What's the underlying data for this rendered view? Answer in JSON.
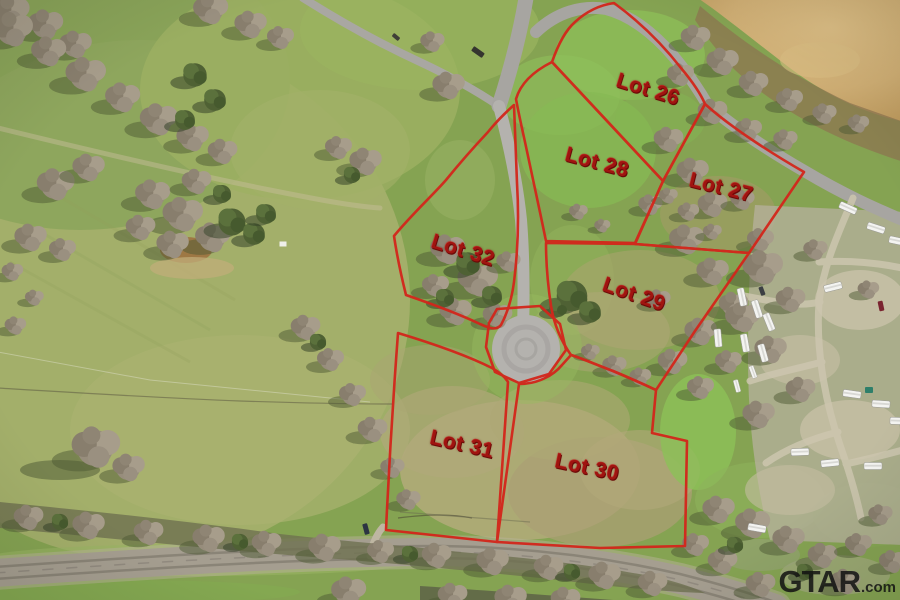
{
  "lots": [
    {
      "id": "26",
      "label": "Lot 26"
    },
    {
      "id": "27",
      "label": "Lot 27"
    },
    {
      "id": "28",
      "label": "Lot 28"
    },
    {
      "id": "29",
      "label": "Lot 29"
    },
    {
      "id": "30",
      "label": "Lot 30"
    },
    {
      "id": "31",
      "label": "Lot 31"
    },
    {
      "id": "32",
      "label": "Lot 32"
    }
  ],
  "watermark": {
    "brand": "GTAR",
    "suffix": ".com"
  },
  "colors": {
    "lot_boundary": "#d3261b",
    "lot_label": "#a01410",
    "watermark_text": "#161616"
  }
}
